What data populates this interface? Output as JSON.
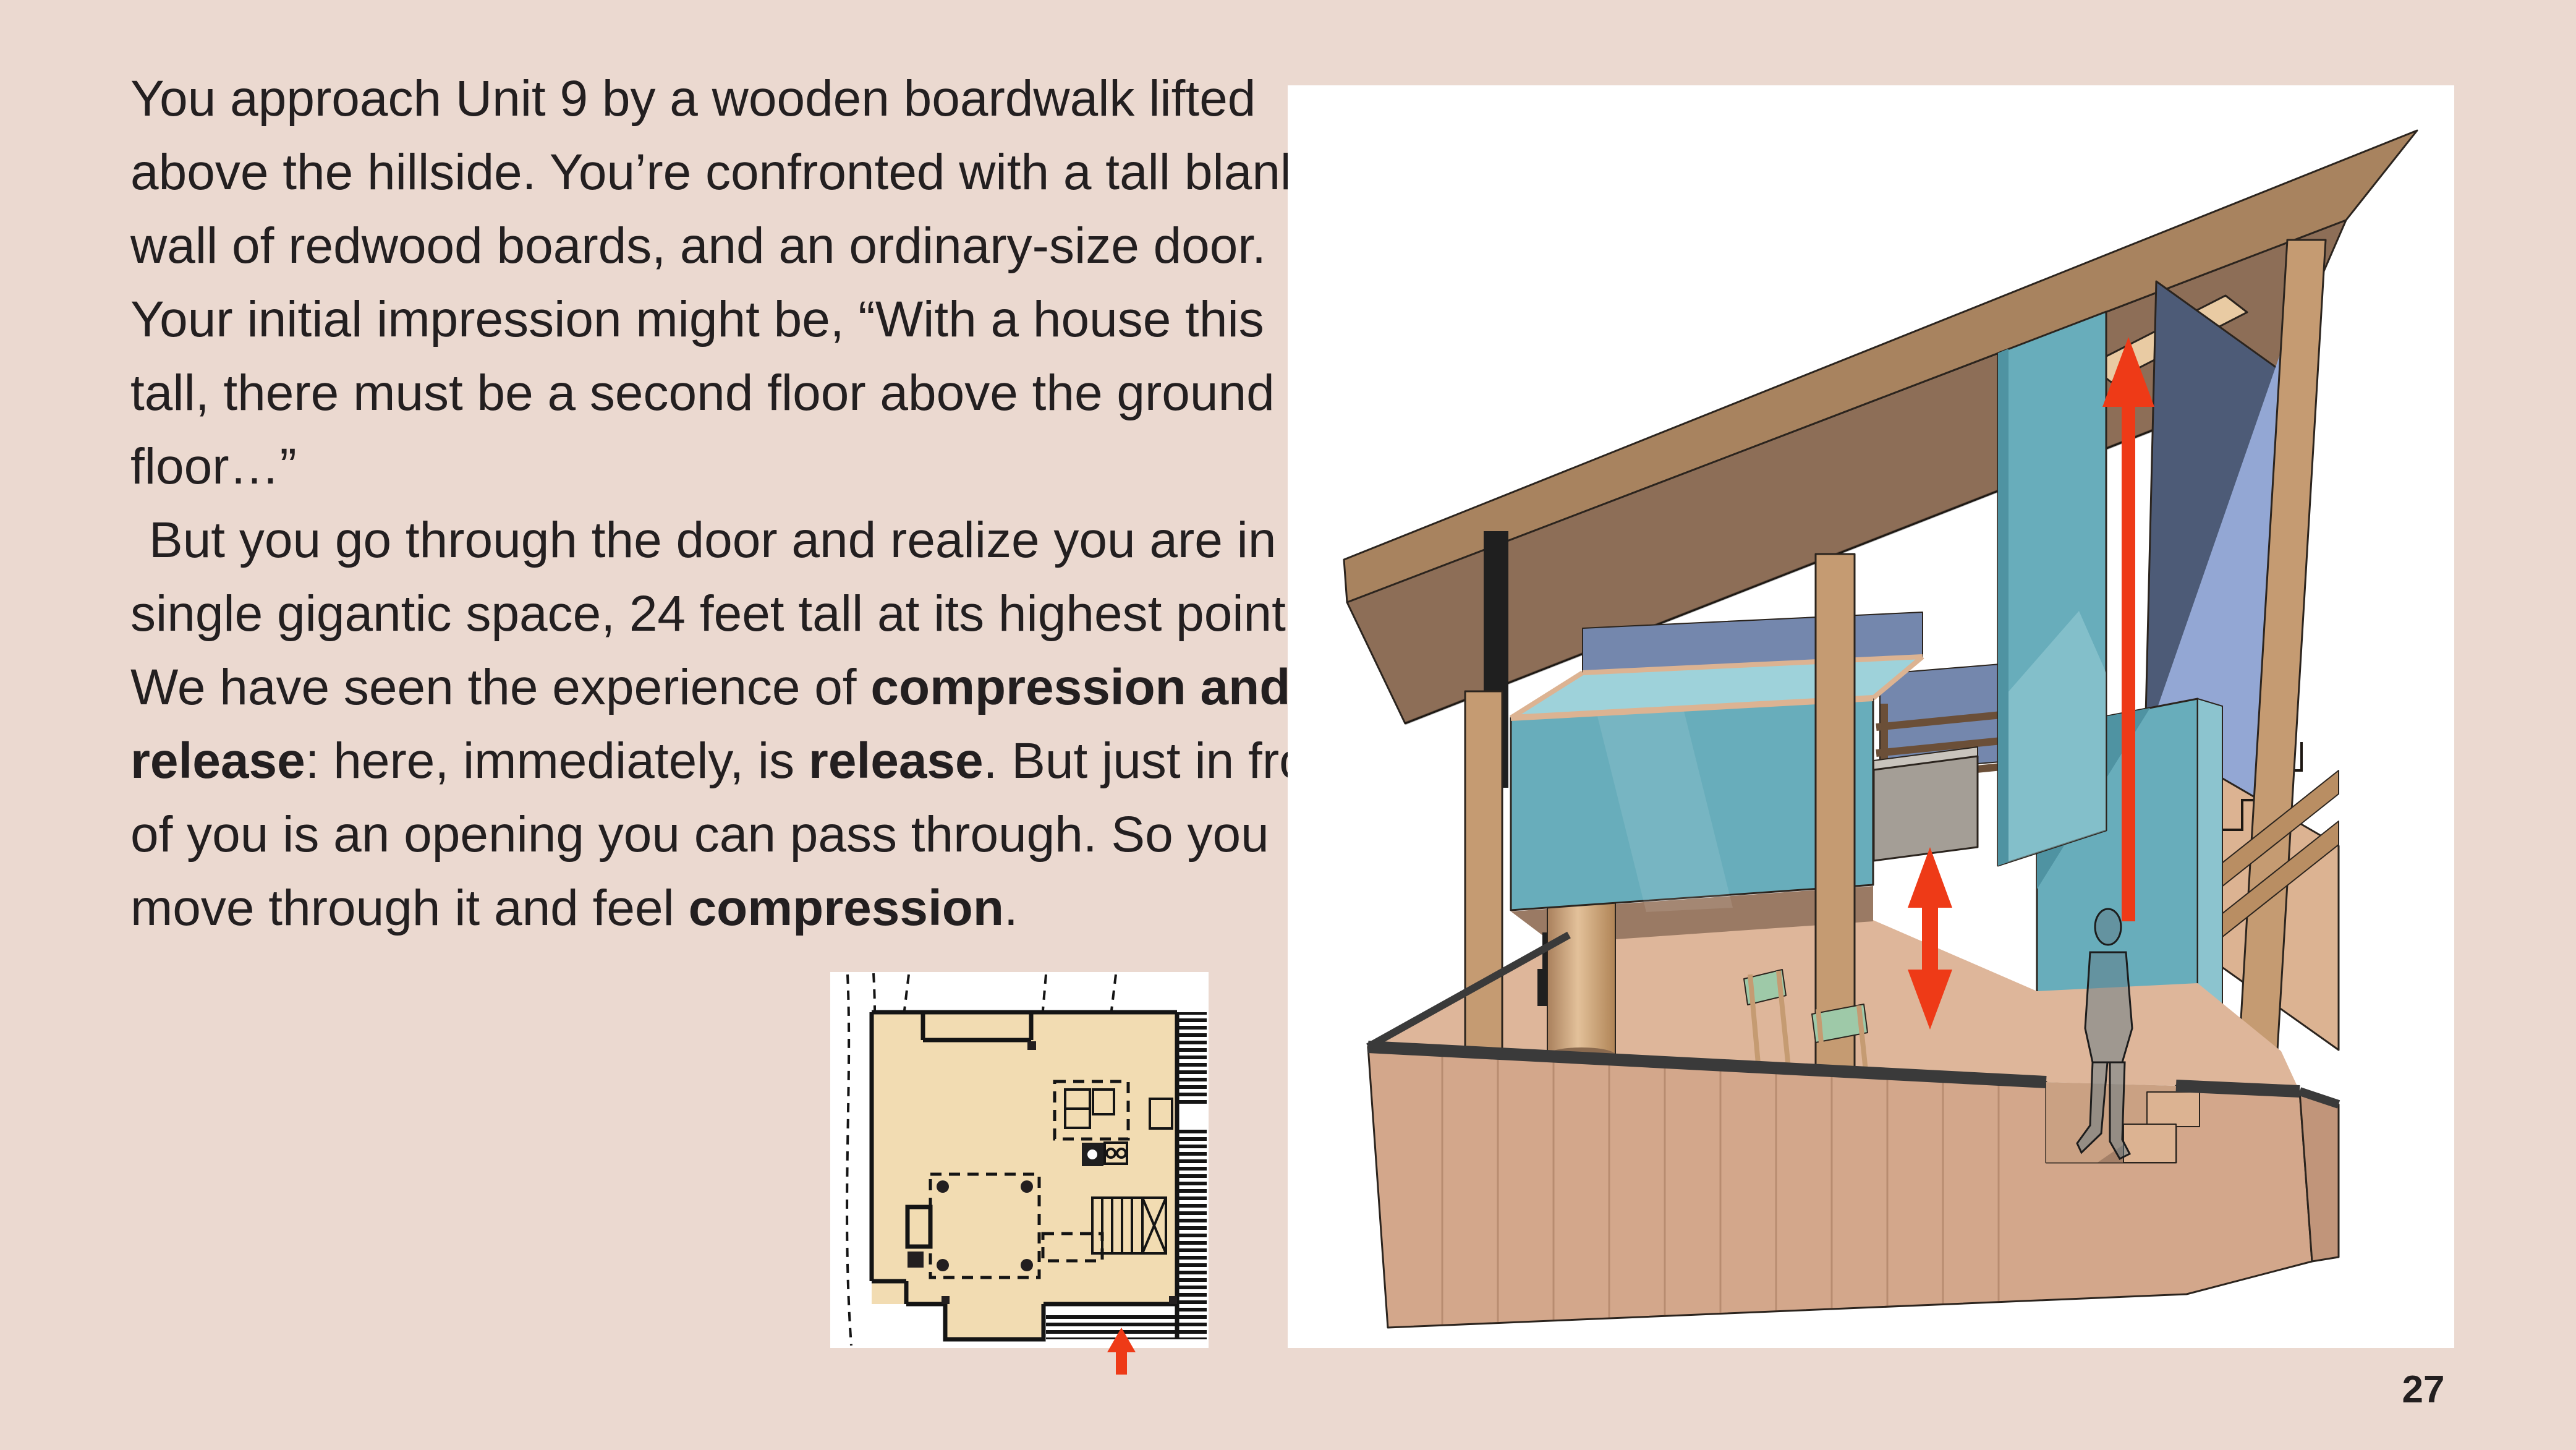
{
  "page": {
    "number": "27",
    "background": "#ebd9d0"
  },
  "colors": {
    "bg": "#ebd9d0",
    "ink": "#231f20",
    "red": "#ee3a17",
    "white": "#ffffff",
    "black": "#1f1f1f",
    "teal": "#68adbb",
    "tealDark": "#4f93a2",
    "tealLight": "#9ed2da",
    "tealPale": "#8cc4cf",
    "blueDark": "#4d5b77",
    "blueLight": "#93a7d4",
    "slate": "#7487ad",
    "wood": "#c59b72",
    "woodLight": "#dcb392",
    "fascia": "#a8835f",
    "soffit": "#8d6e57",
    "rail": "#6b4f38",
    "stringer": "#b98e63",
    "plyFront": "#d3a78b",
    "plyFloor": "#deb69a",
    "plyRight": "#c1957a",
    "underloft": "#9a7a64",
    "band": "#3a3a3a",
    "cream": "#e9cba3",
    "gray": "#a49e96",
    "grayLight": "#c9c4bd",
    "planCream": "#f2dcb2",
    "canvas": "#9ec9a8"
  },
  "article": {
    "lines": [
      {
        "segments": [
          {
            "text": "You approach Unit 9 by a wooden boardwalk lifted"
          }
        ]
      },
      {
        "segments": [
          {
            "text": "above the hillside. You’re confronted with a tall blank"
          }
        ]
      },
      {
        "segments": [
          {
            "text": "wall of redwood boards, and an ordinary-size door."
          }
        ]
      },
      {
        "segments": [
          {
            "text": "Your initial impression might be, “With a house this"
          }
        ]
      },
      {
        "segments": [
          {
            "text": "tall, there must be a second floor above the ground"
          }
        ]
      },
      {
        "segments": [
          {
            "text": "floor…”"
          }
        ]
      },
      {
        "indent": true,
        "segments": [
          {
            "text": "But you go through the door and realize you are in a"
          }
        ]
      },
      {
        "segments": [
          {
            "text": "single gigantic space, 24 feet tall at its highest point."
          }
        ]
      },
      {
        "segments": [
          {
            "text": "We have seen the experience of "
          },
          {
            "text": "compression and",
            "bold": true
          }
        ]
      },
      {
        "segments": [
          {
            "text": "release",
            "bold": true
          },
          {
            "text": ": here, immediately, is "
          },
          {
            "text": "release",
            "bold": true
          },
          {
            "text": ". But just in front"
          }
        ]
      },
      {
        "segments": [
          {
            "text": "of you is an opening you can pass through. So you"
          }
        ]
      },
      {
        "segments": [
          {
            "text": "move through it and feel "
          },
          {
            "text": "compression",
            "bold": true
          },
          {
            "text": "."
          }
        ]
      }
    ]
  }
}
